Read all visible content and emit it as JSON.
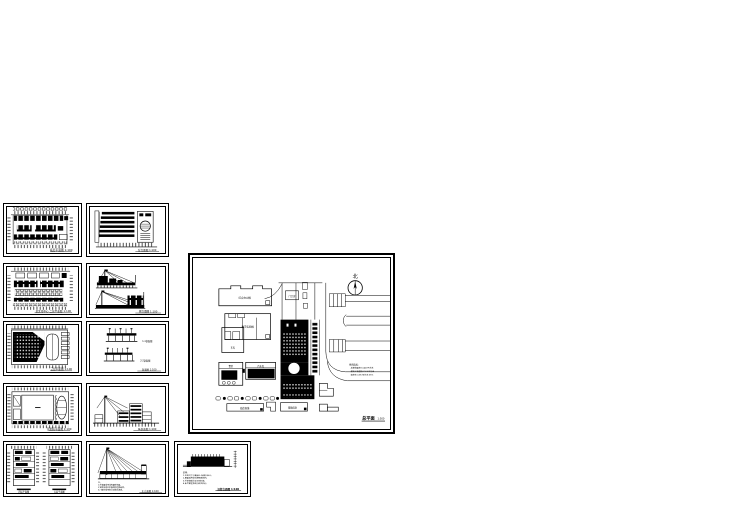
{
  "page": {
    "background": "#ffffff",
    "ink": "#000000"
  },
  "sheets": {
    "c1r1": {
      "caption": "底层平面图 1:100"
    },
    "c1r2": {
      "caption": "某文化中心 二层平面图 1:100"
    },
    "c1r3": {
      "caption": "三层平面图 1:100"
    },
    "c1r4": {
      "caption": "影剧院平面图 1:100"
    },
    "c1r5": {
      "caption_left": "四层平面图",
      "caption_right": "五层平面图"
    },
    "c2r1": {
      "caption": "背立面图 1:100"
    },
    "c2r2": {
      "caption": "侧立面图 1:100"
    },
    "c2r3": {
      "caption_top": "1-1剖面图",
      "caption_bottom": "2-2剖面图",
      "caption": "剖面图 1:100"
    },
    "c2r4": {
      "caption": "纵剖面图 1:100"
    },
    "c2r5": {
      "caption": "正立面图 1:100",
      "notes": [
        "注:",
        "1.外墙面采用浅色面砖饰面。",
        "2.钢索及桅杆表面刷银色氟碳漆。",
        "3.门窗均采用铝合金框白玻璃。"
      ]
    },
    "c3r5": {
      "caption": "沿街立面图 1:100",
      "notes": [
        "说明:",
        "1.本图尺寸以毫米计,标高以米计。",
        "2.屋面采用张拉膜钢索结构。",
        "3.外装修做法详见材料表。",
        "4.未尽事宜按现行规范执行。"
      ]
    }
  },
  "site_plan": {
    "north_label": "北",
    "caption": "总平面",
    "scale": "1:500",
    "legend": [
      "经济指标:",
      "总建筑面积:10400平方米",
      "建筑占地面积:3100平方米",
      "容积率:0.85 绿化率:35%"
    ],
    "labels": {
      "bldg_a": "综合办公楼",
      "bldg_b": "教学实验楼",
      "bldg_b_wing": "车库",
      "bldg_c1": "食堂",
      "bldg_c2": "汽车库",
      "bldg_d": "临街商铺",
      "bldg_e": "辅助用房",
      "gate": "门卫房"
    }
  }
}
